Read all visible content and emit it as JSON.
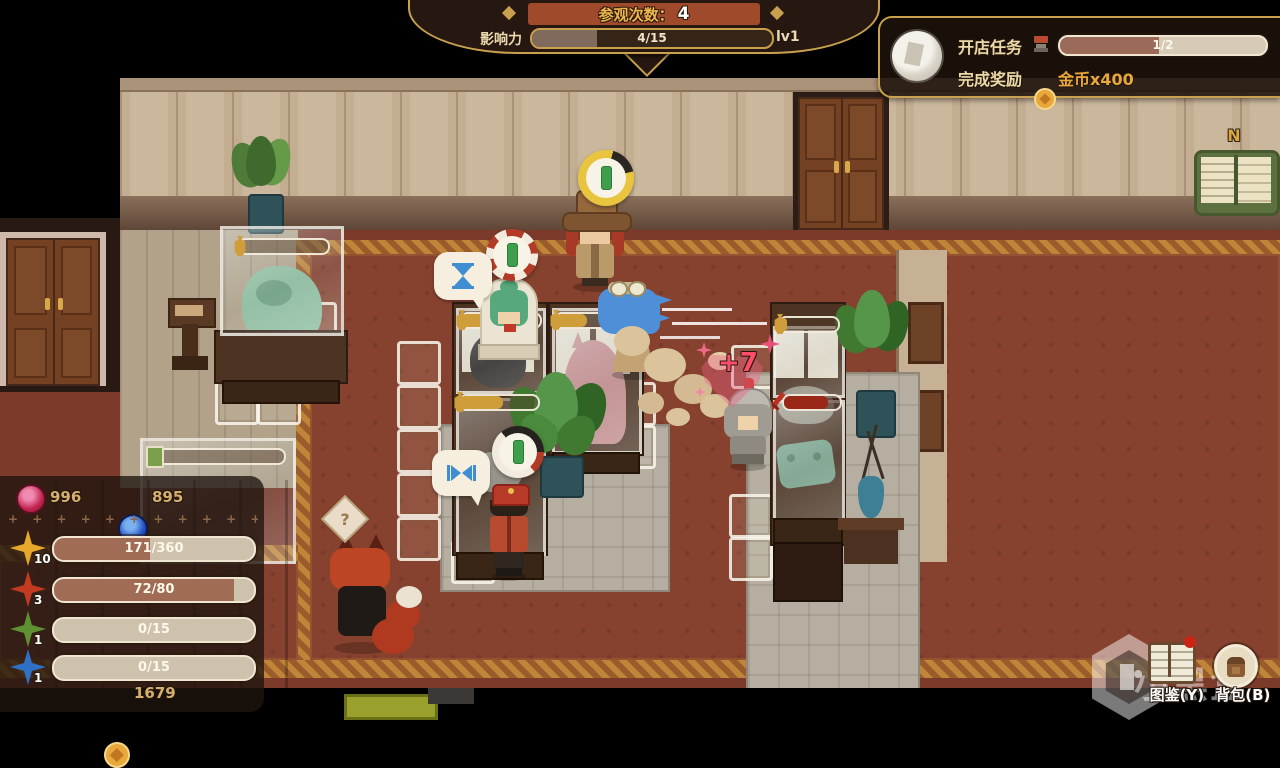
{
  "hud": {
    "top_banner": {
      "visits_label": "参观次数：",
      "visits_value": "4",
      "influence_label": "影响力",
      "influence_text": "4/15",
      "influence_pct": 27,
      "level": "lv1"
    },
    "quest": {
      "title": "开店任务",
      "progress_text": "1/2",
      "progress_pct": 48,
      "reward_label": "完成奖励",
      "reward_text": "金币x400"
    },
    "minimap": {
      "north": "N"
    },
    "stats": {
      "red_gem": "996",
      "blue_gem": "895",
      "divider": "+ + + + + + + + + + + + + +",
      "bars": [
        {
          "level": "10",
          "text": "171/360",
          "pct": 48,
          "color": "#e8a82c"
        },
        {
          "level": "3",
          "text": "72/80",
          "pct": 90,
          "color": "#c23a20"
        },
        {
          "level": "1",
          "text": "0/15",
          "pct": 0,
          "color": "#5f9032"
        },
        {
          "level": "1",
          "text": "0/15",
          "pct": 0,
          "color": "#2f6fc4"
        }
      ],
      "coins": "1679"
    },
    "shortcuts": {
      "catalog": "图鉴(Y)",
      "backpack": "背包(B)"
    },
    "watermark": "小黑盒"
  },
  "scene": {
    "effects": {
      "heal": "+7",
      "question": "?"
    },
    "case_bars": [
      {
        "name": "dragon-case",
        "pct": 0
      },
      {
        "name": "stone-case",
        "pct": 65
      },
      {
        "name": "horse-case",
        "pct": 40
      },
      {
        "name": "rock-case",
        "pct": 55
      },
      {
        "name": "right-case",
        "pct": 12
      },
      {
        "name": "book-case",
        "pct": 0
      },
      {
        "name": "sword-case",
        "pct": 78
      }
    ]
  }
}
